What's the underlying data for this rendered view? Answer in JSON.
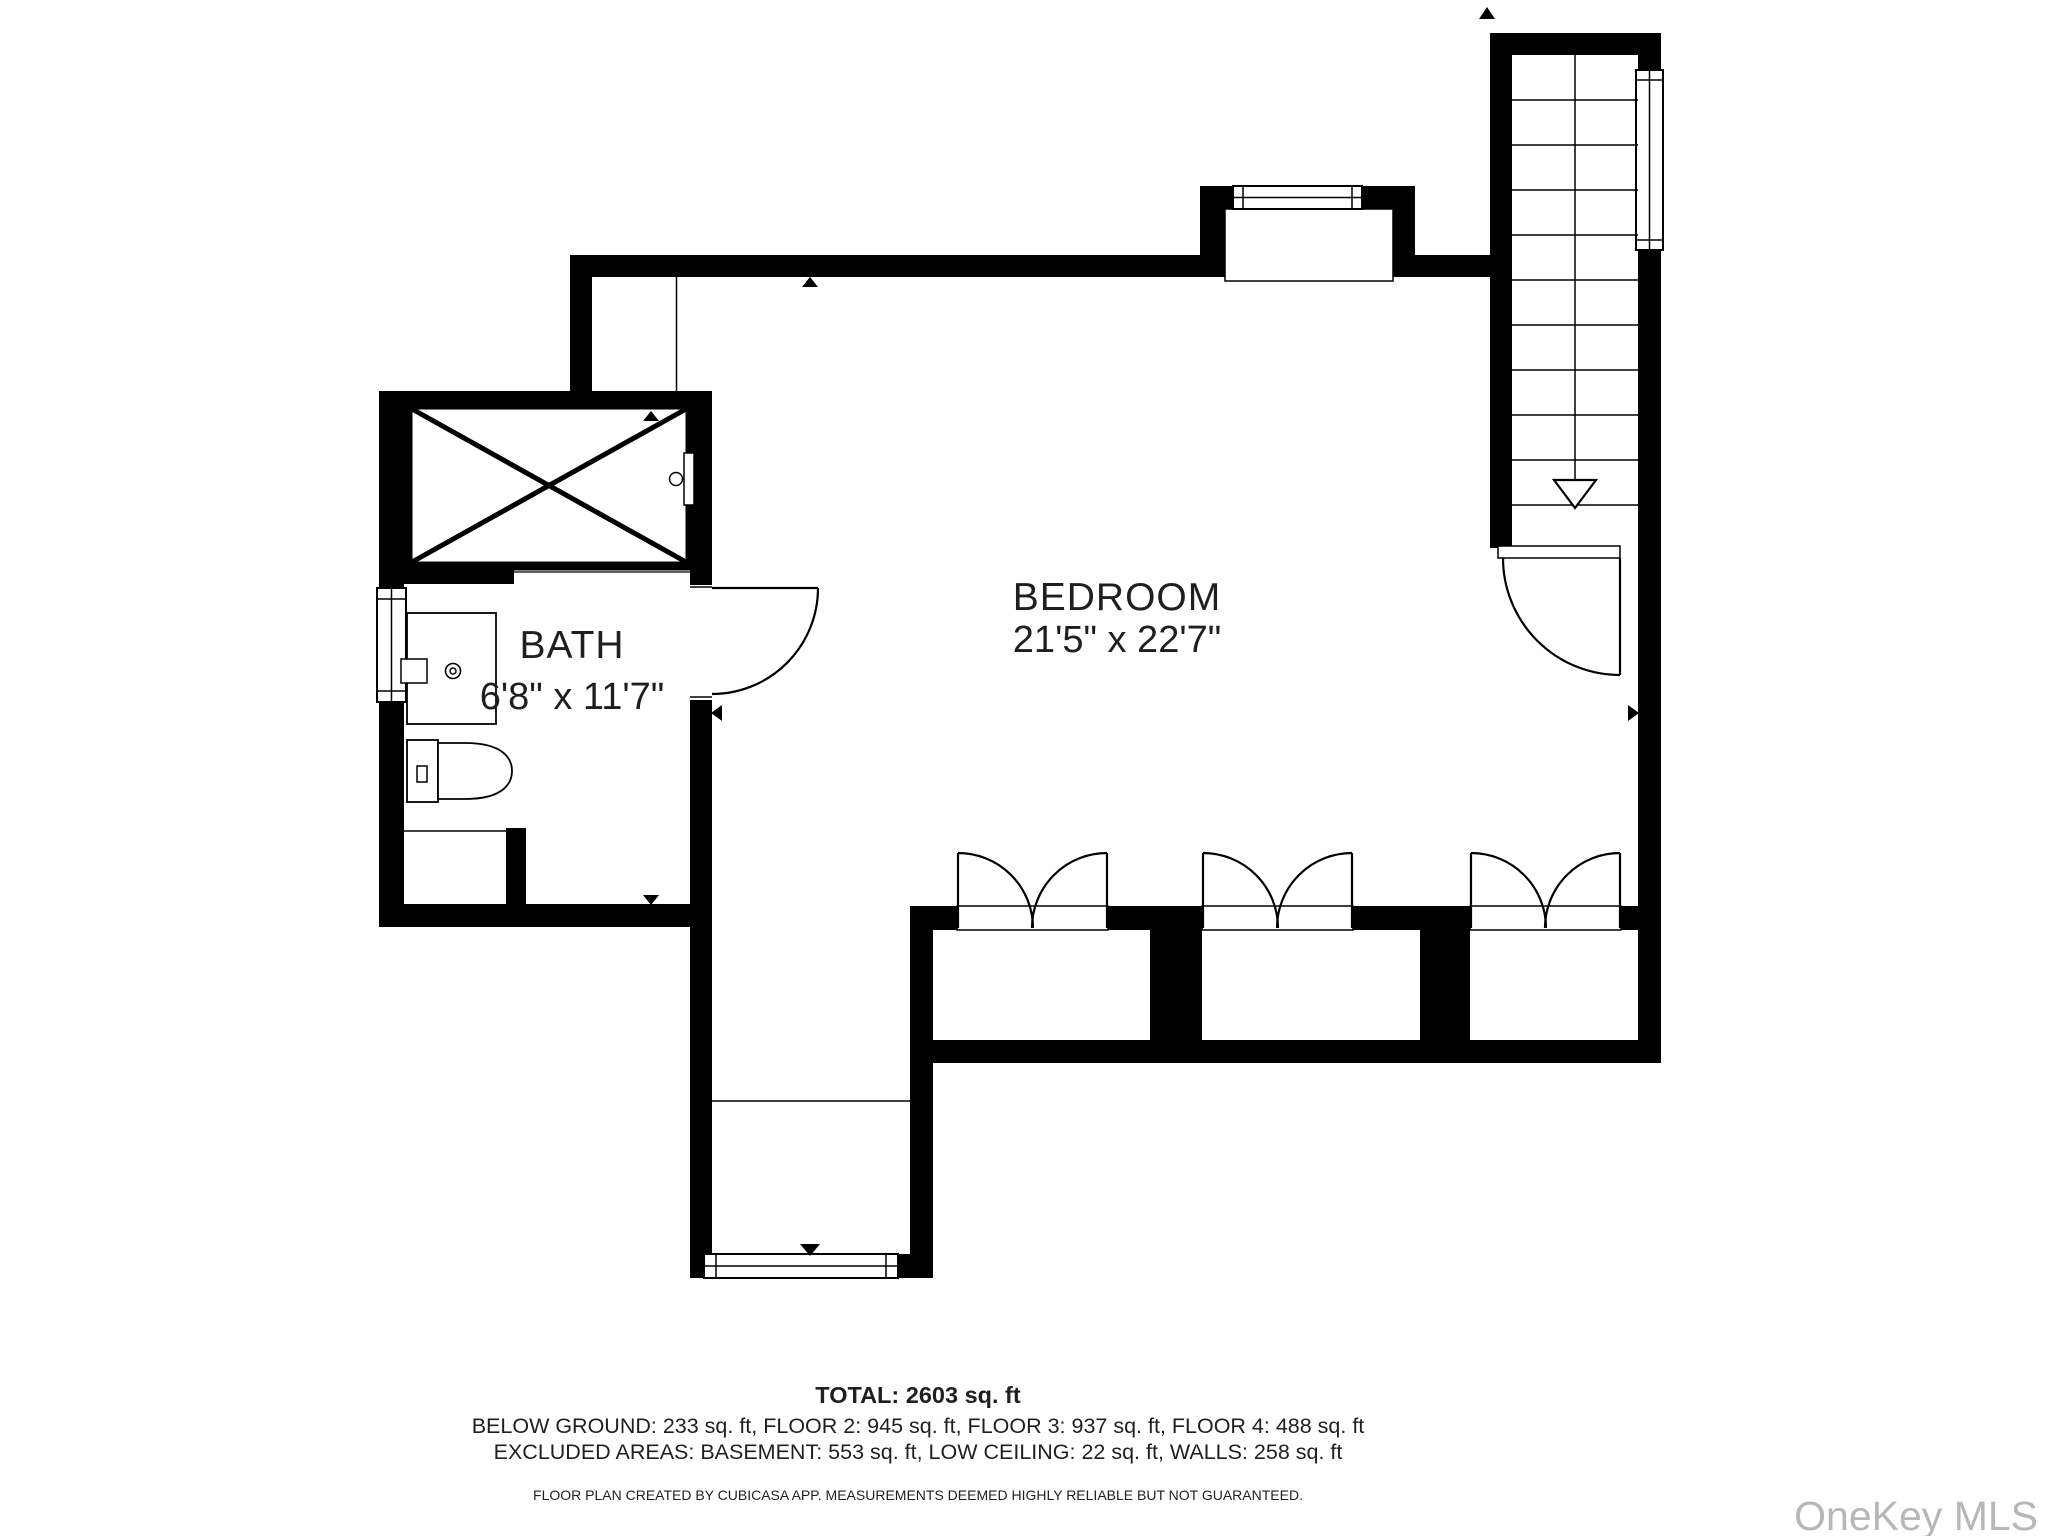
{
  "plan": {
    "rooms": [
      {
        "name": "BEDROOM",
        "dims": "21'5\" x 22'7\""
      },
      {
        "name": "BATH",
        "dims": "6'8\" x 11'7\""
      }
    ],
    "summary": {
      "total": "TOTAL: 2603 sq. ft",
      "floors": "BELOW GROUND: 233 sq. ft, FLOOR 2: 945 sq. ft, FLOOR 3: 937 sq. ft, FLOOR 4: 488 sq. ft",
      "excluded": "EXCLUDED AREAS: BASEMENT: 553 sq. ft, LOW CEILING: 22 sq. ft, WALLS: 258 sq. ft",
      "disclaimer": "FLOOR PLAN CREATED BY CUBICASA APP. MEASUREMENTS DEEMED HIGHLY RELIABLE BUT NOT GUARANTEED."
    },
    "watermark": "OneKey MLS",
    "colors": {
      "wall": "#000000",
      "watermark": "#b7b7b7"
    }
  }
}
